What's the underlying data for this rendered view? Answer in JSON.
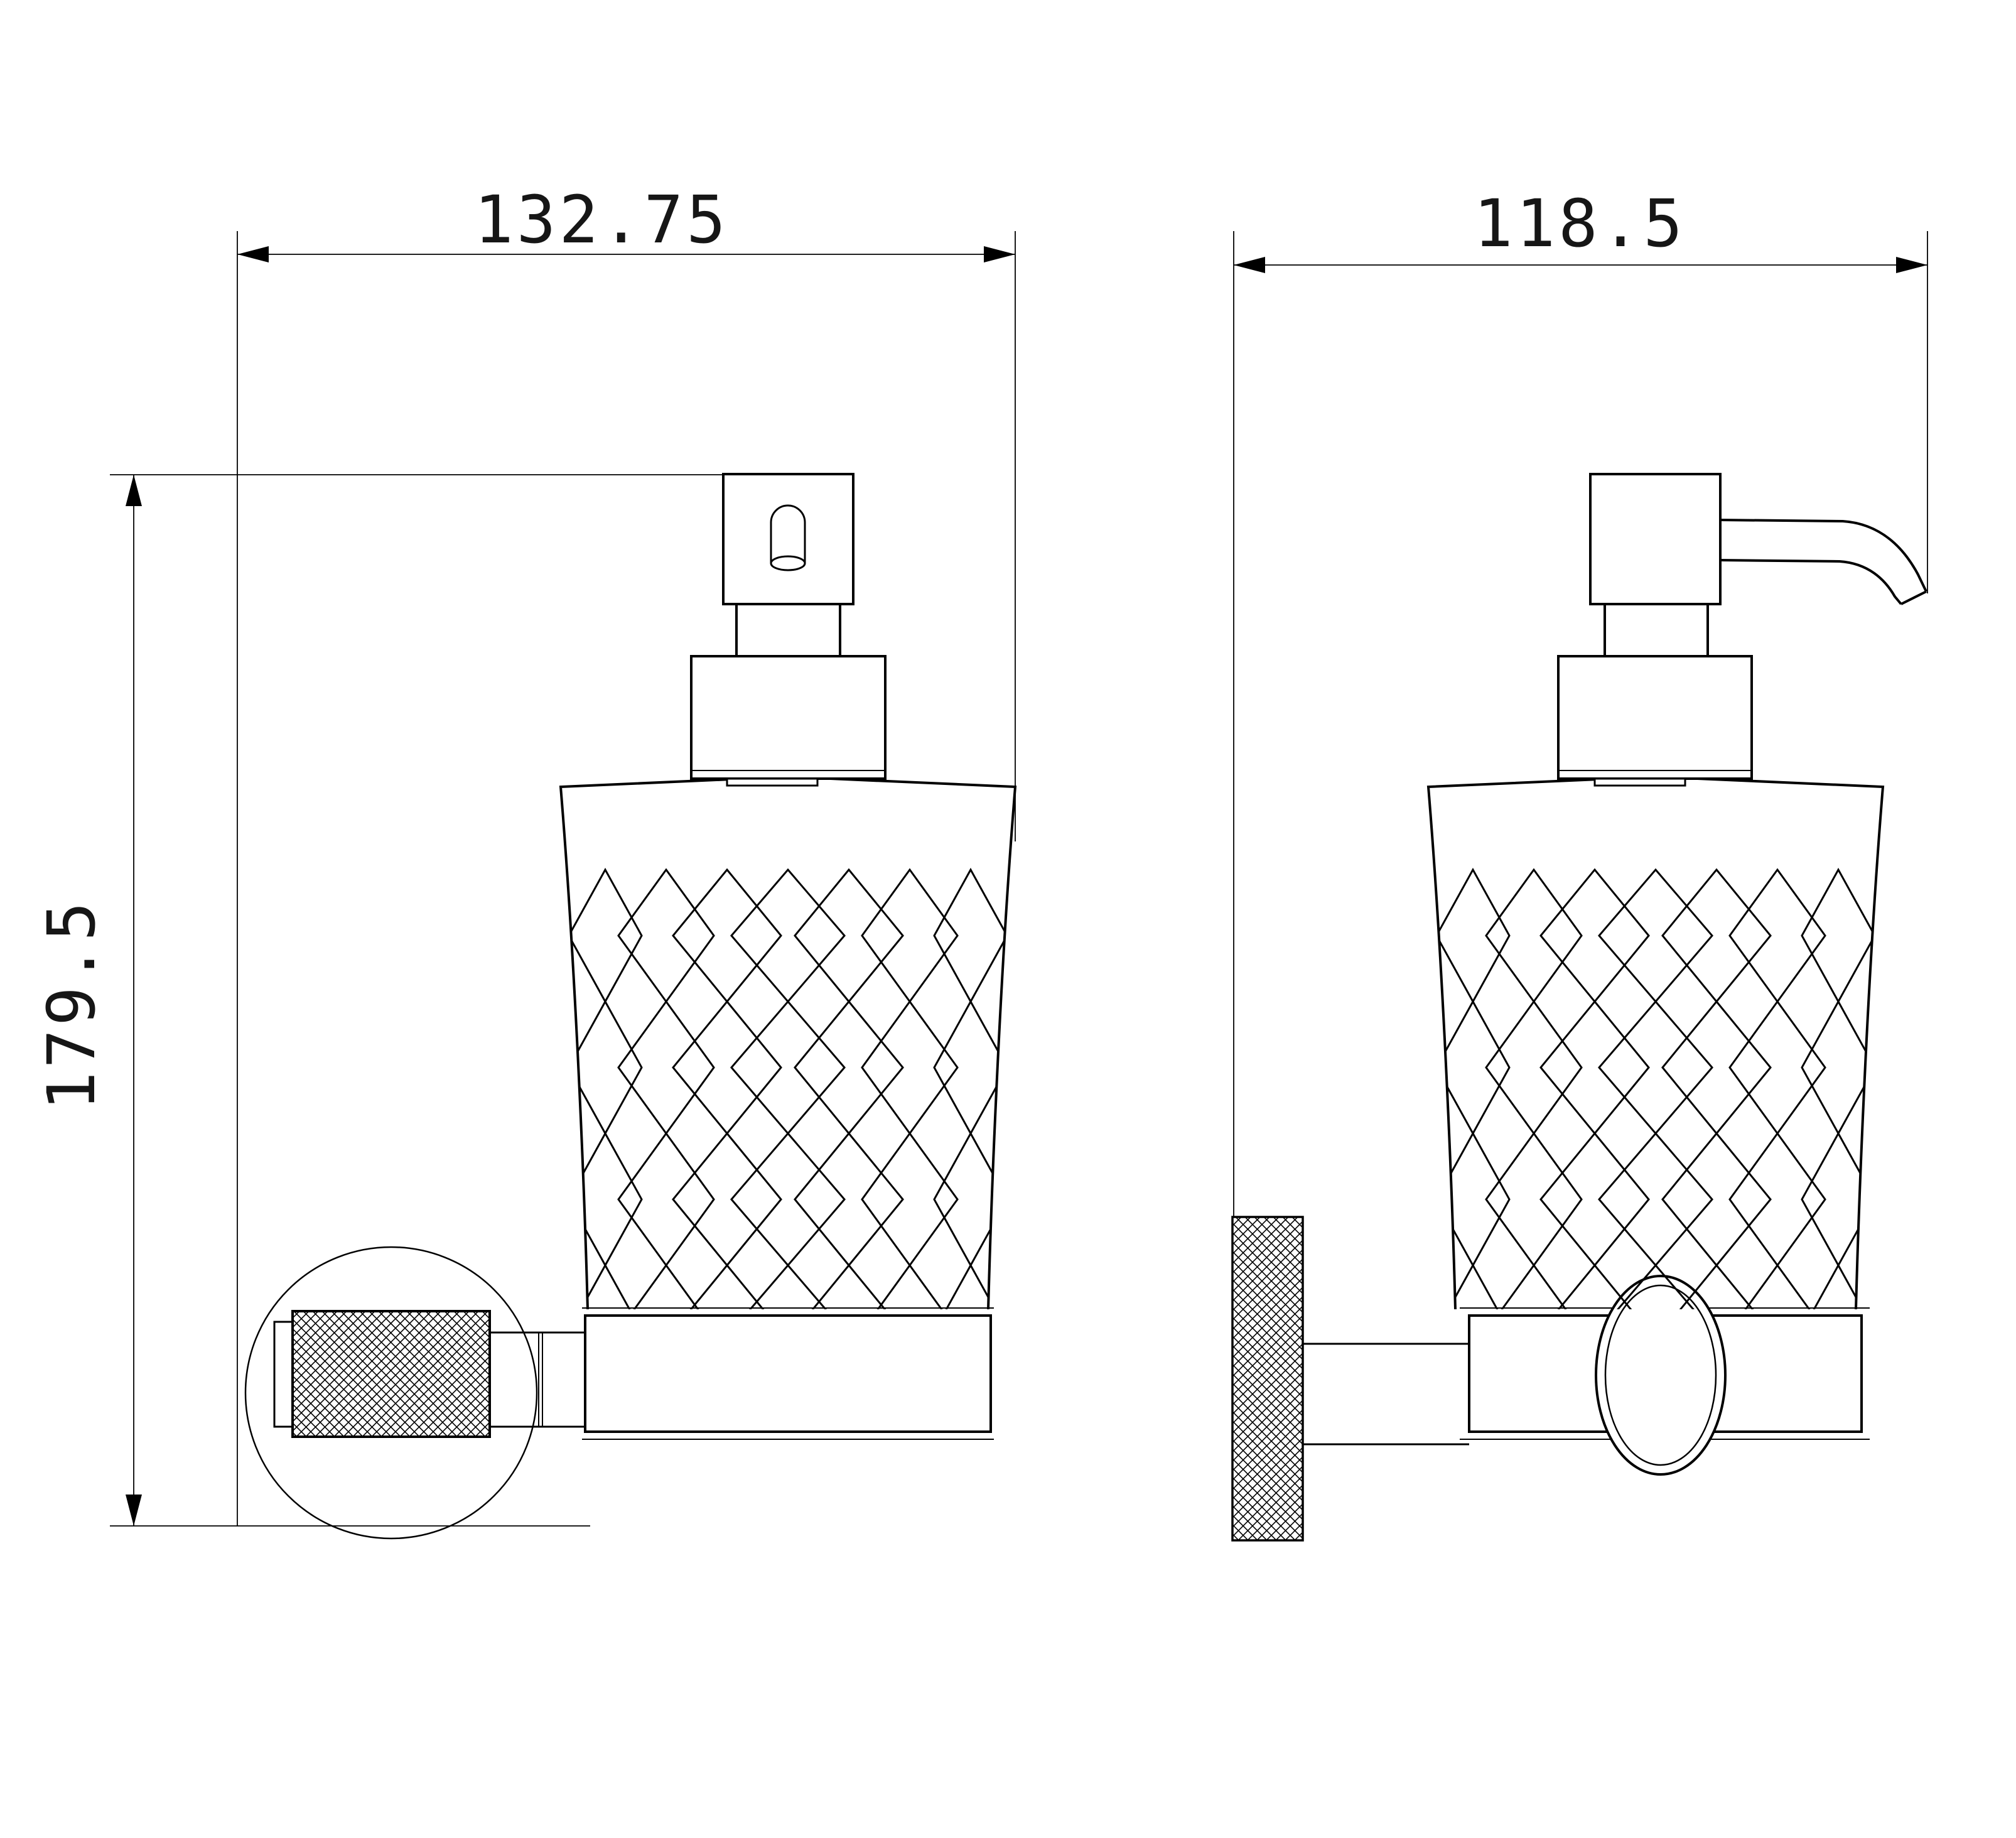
{
  "drawing": {
    "title": "soap-dispenser-technical-drawing",
    "dimensions": {
      "front_width": {
        "value": "132.75"
      },
      "side_width": {
        "value": "118.5"
      },
      "height": {
        "value": "179.5"
      }
    },
    "colors": {
      "line": "#000000",
      "background": "#ffffff"
    }
  }
}
